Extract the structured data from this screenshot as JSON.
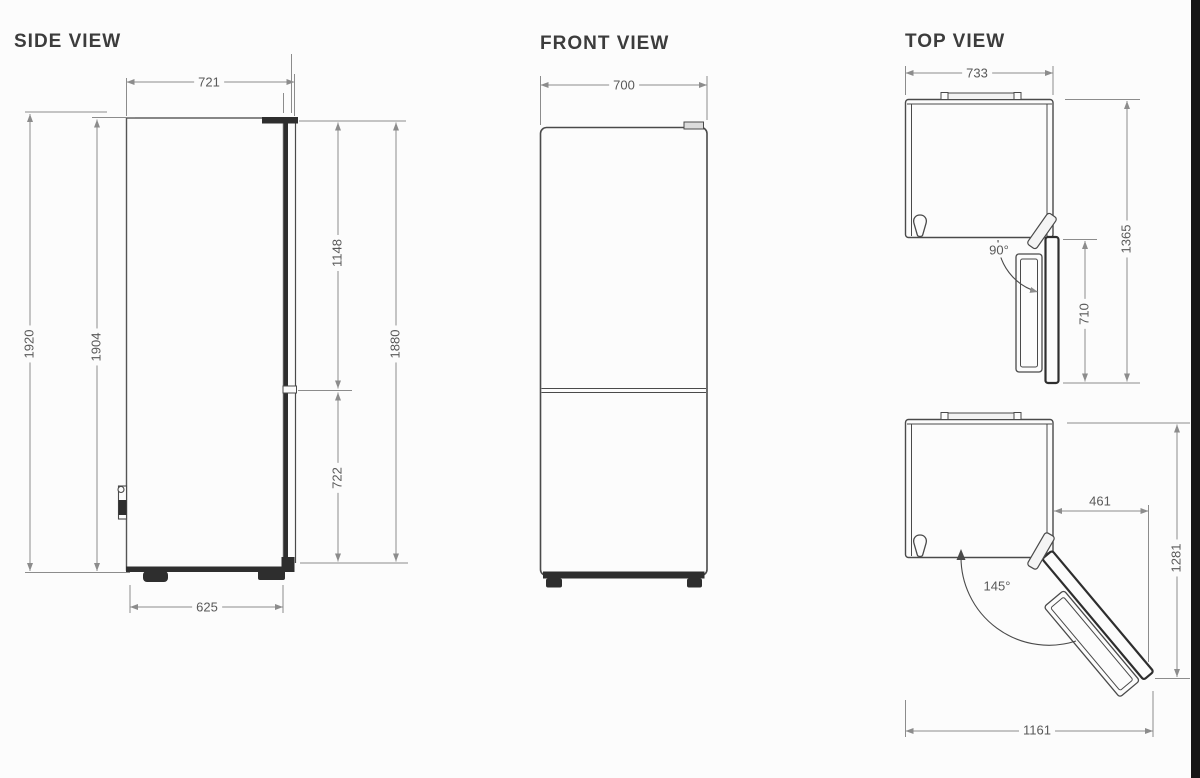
{
  "side_view": {
    "title": "SIDE VIEW",
    "dims": {
      "top_depth": "721",
      "total_height": "1920",
      "cabinet_height": "1904",
      "upper_door_height": "1148",
      "door_height": "1880",
      "lower_door_height": "722",
      "base_depth": "625"
    }
  },
  "front_view": {
    "title": "FRONT VIEW",
    "dims": {
      "width": "700"
    }
  },
  "top_view": {
    "title": "TOP VIEW",
    "dims": {
      "width": "733",
      "open_90_angle": "90°",
      "door_width_90": "710",
      "depth_open_90": "1365",
      "overhang_open_145": "461",
      "open_145_angle": "145°",
      "depth_open_145": "1281",
      "width_open_145": "1161"
    }
  },
  "colors": {
    "object_line": "#4a4a4a",
    "dark_fill": "#2e2e2e",
    "dimension_line": "#8c8c8c",
    "text": "#595959",
    "background": "#fcfcfc",
    "edge_bar": "#161616"
  }
}
